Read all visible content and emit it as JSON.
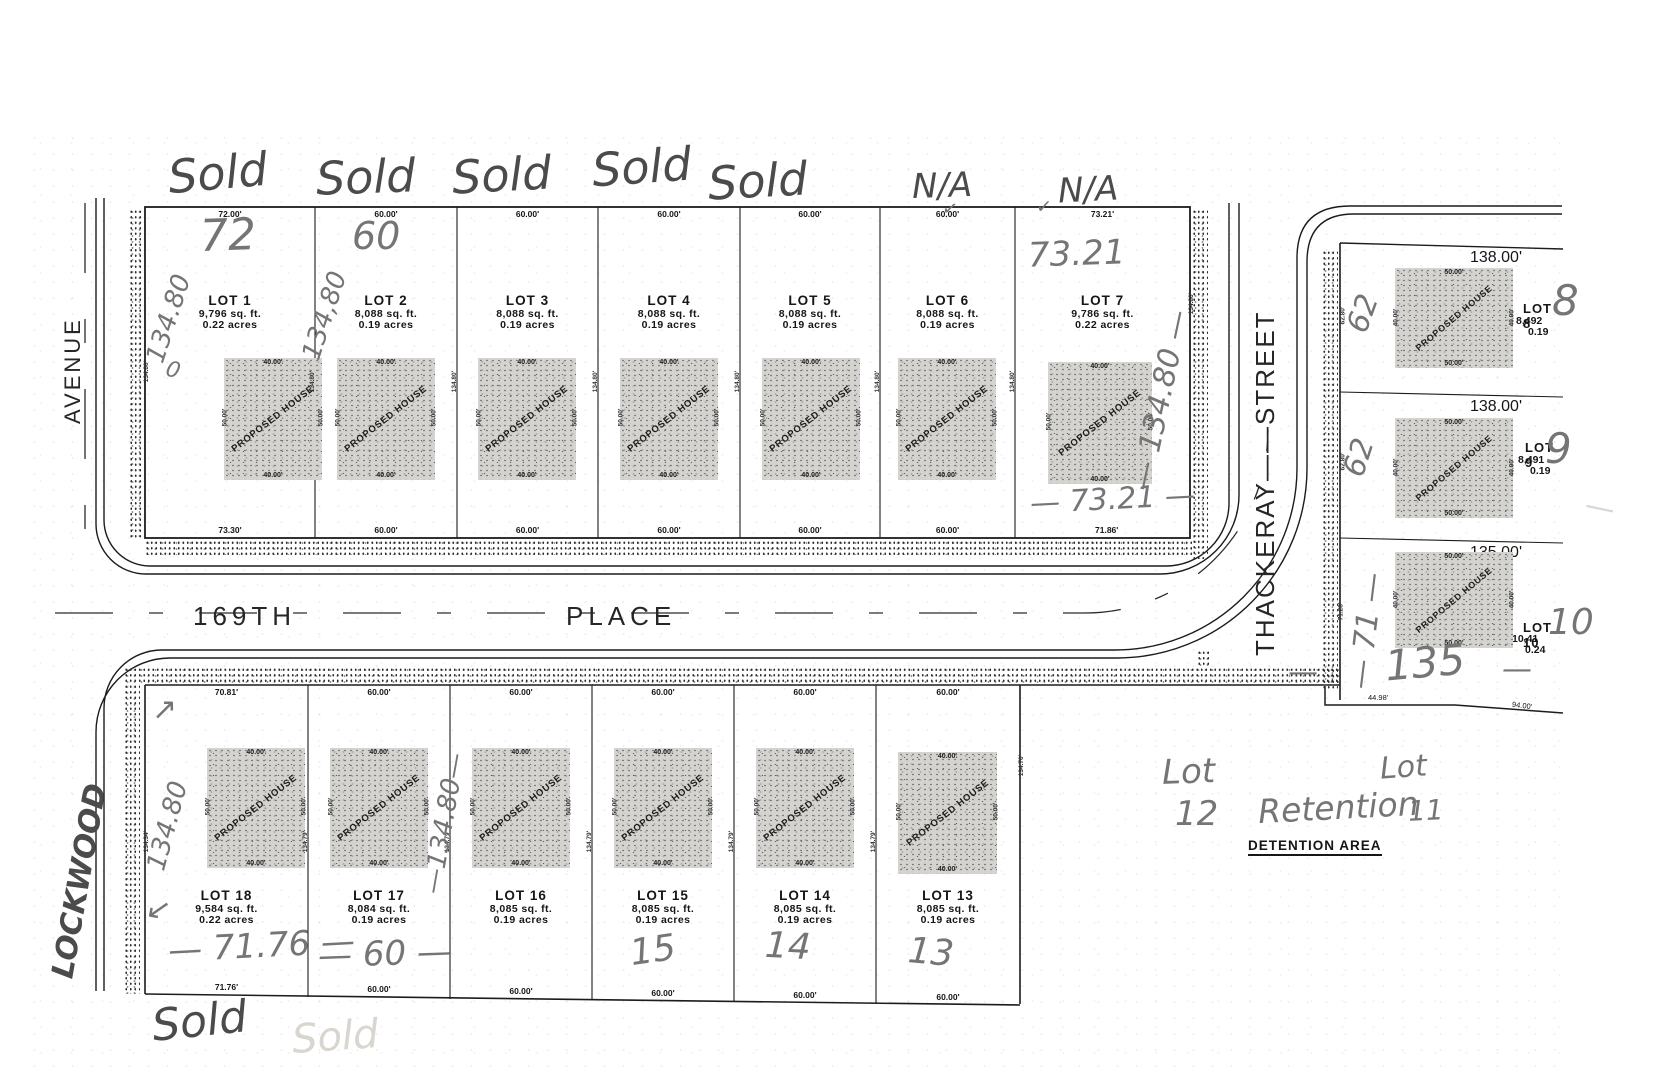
{
  "streets": {
    "avenue": "AVENUE",
    "place_w": "169TH",
    "place_e": "PLACE",
    "thackeray": "THACKERAY——STREET"
  },
  "labels": {
    "detention": "DETENTION AREA"
  },
  "house": {
    "label": "PROPOSED HOUSE",
    "w": "40.00'",
    "side": "50.00'",
    "rw": "50.00'",
    "rside": "40.00'"
  },
  "lots_top": [
    {
      "name": "LOT 1",
      "sqft": "9,796 sq. ft.",
      "acres": "0.22 acres",
      "top": "72.00'",
      "bottom": "73.30'"
    },
    {
      "name": "LOT 2",
      "sqft": "8,088 sq. ft.",
      "acres": "0.19 acres",
      "top": "60.00'",
      "bottom": "60.00'"
    },
    {
      "name": "LOT 3",
      "sqft": "8,088 sq. ft.",
      "acres": "0.19 acres",
      "top": "60.00'",
      "bottom": "60.00'"
    },
    {
      "name": "LOT 4",
      "sqft": "8,088 sq. ft.",
      "acres": "0.19 acres",
      "top": "60.00'",
      "bottom": "60.00'"
    },
    {
      "name": "LOT 5",
      "sqft": "8,088 sq. ft.",
      "acres": "0.19 acres",
      "top": "60.00'",
      "bottom": "60.00'"
    },
    {
      "name": "LOT 6",
      "sqft": "8,088 sq. ft.",
      "acres": "0.19 acres",
      "top": "60.00'",
      "bottom": "60.00'"
    },
    {
      "name": "LOT 7",
      "sqft": "9,786 sq. ft.",
      "acres": "0.22 acres",
      "top": "73.21'",
      "bottom": "71.86'"
    }
  ],
  "lots_bottom": [
    {
      "name": "LOT 18",
      "sqft": "9,584 sq. ft.",
      "acres": "0.22 acres",
      "top": "70.81'",
      "bottom": "71.76'"
    },
    {
      "name": "LOT 17",
      "sqft": "8,084 sq. ft.",
      "acres": "0.19 acres",
      "top": "60.00'",
      "bottom": "60.00'"
    },
    {
      "name": "LOT 16",
      "sqft": "8,085 sq. ft.",
      "acres": "0.19 acres",
      "top": "60.00'",
      "bottom": "60.00'"
    },
    {
      "name": "LOT 15",
      "sqft": "8,085 sq. ft.",
      "acres": "0.19 acres",
      "top": "60.00'",
      "bottom": "60.00'"
    },
    {
      "name": "LOT 14",
      "sqft": "8,085 sq. ft.",
      "acres": "0.19 acres",
      "top": "60.00'",
      "bottom": "60.00'"
    },
    {
      "name": "LOT 13",
      "sqft": "8,085 sq. ft.",
      "acres": "0.19 acres",
      "top": "60.00'",
      "bottom": "60.00'"
    }
  ],
  "lots_right": [
    {
      "name": "LOT 8",
      "sqft": "8,492",
      "acres": "0.19",
      "top": "138.00'"
    },
    {
      "name": "LOT 9",
      "sqft": "8,491",
      "acres": "0.19",
      "top": "138.00'"
    },
    {
      "name": "LOT 10",
      "sqft": "10,41",
      "acres": "0.24",
      "top": "135.00'"
    }
  ],
  "dims": {
    "side_top": "134.80'",
    "side_bottom": "134.79'",
    "west_bottom": "134.34'",
    "east_top": "134.80'",
    "east_bottom": "134.70'",
    "sw4498": "44.98'",
    "se9400": "94.00'",
    "r_west": [
      "62.80'",
      "62.80'",
      "71.28'"
    ]
  },
  "hw": {
    "sold": [
      "Sold",
      "Sold",
      "Sold",
      "Sold",
      "Sold"
    ],
    "na": [
      "N/A",
      "N/A"
    ],
    "check": "✓",
    "w72": "72",
    "w60": "60",
    "w7321": "73.21",
    "d134_1": "134.80",
    "d134_2": "134,80",
    "d134_7": "— 134.80 —",
    "w7321b": "— 73.21 —",
    "circle": "0",
    "arrow_ne": "↗",
    "arrow_sw": "↙",
    "d134_18": "134.80",
    "d134_17": "—134.80—",
    "w7176": "— 71.76 —",
    "w60b": "— 60 —",
    "n15": "15",
    "n14": "14",
    "n13": "13",
    "lockwood": "LOCKWOOD",
    "r62a": "62",
    "r62b": "62",
    "r71": "— 71 —",
    "n8": "8",
    "n9": "9",
    "n10": "10",
    "n135": "135",
    "dash": "—",
    "lot_a": "Lot",
    "lot_a_num": "12",
    "retention": "Retention",
    "lot_b": "Lot",
    "lot_b_num": "11",
    "sold_bottom": "Sold",
    "sold_faint": "Sold"
  }
}
